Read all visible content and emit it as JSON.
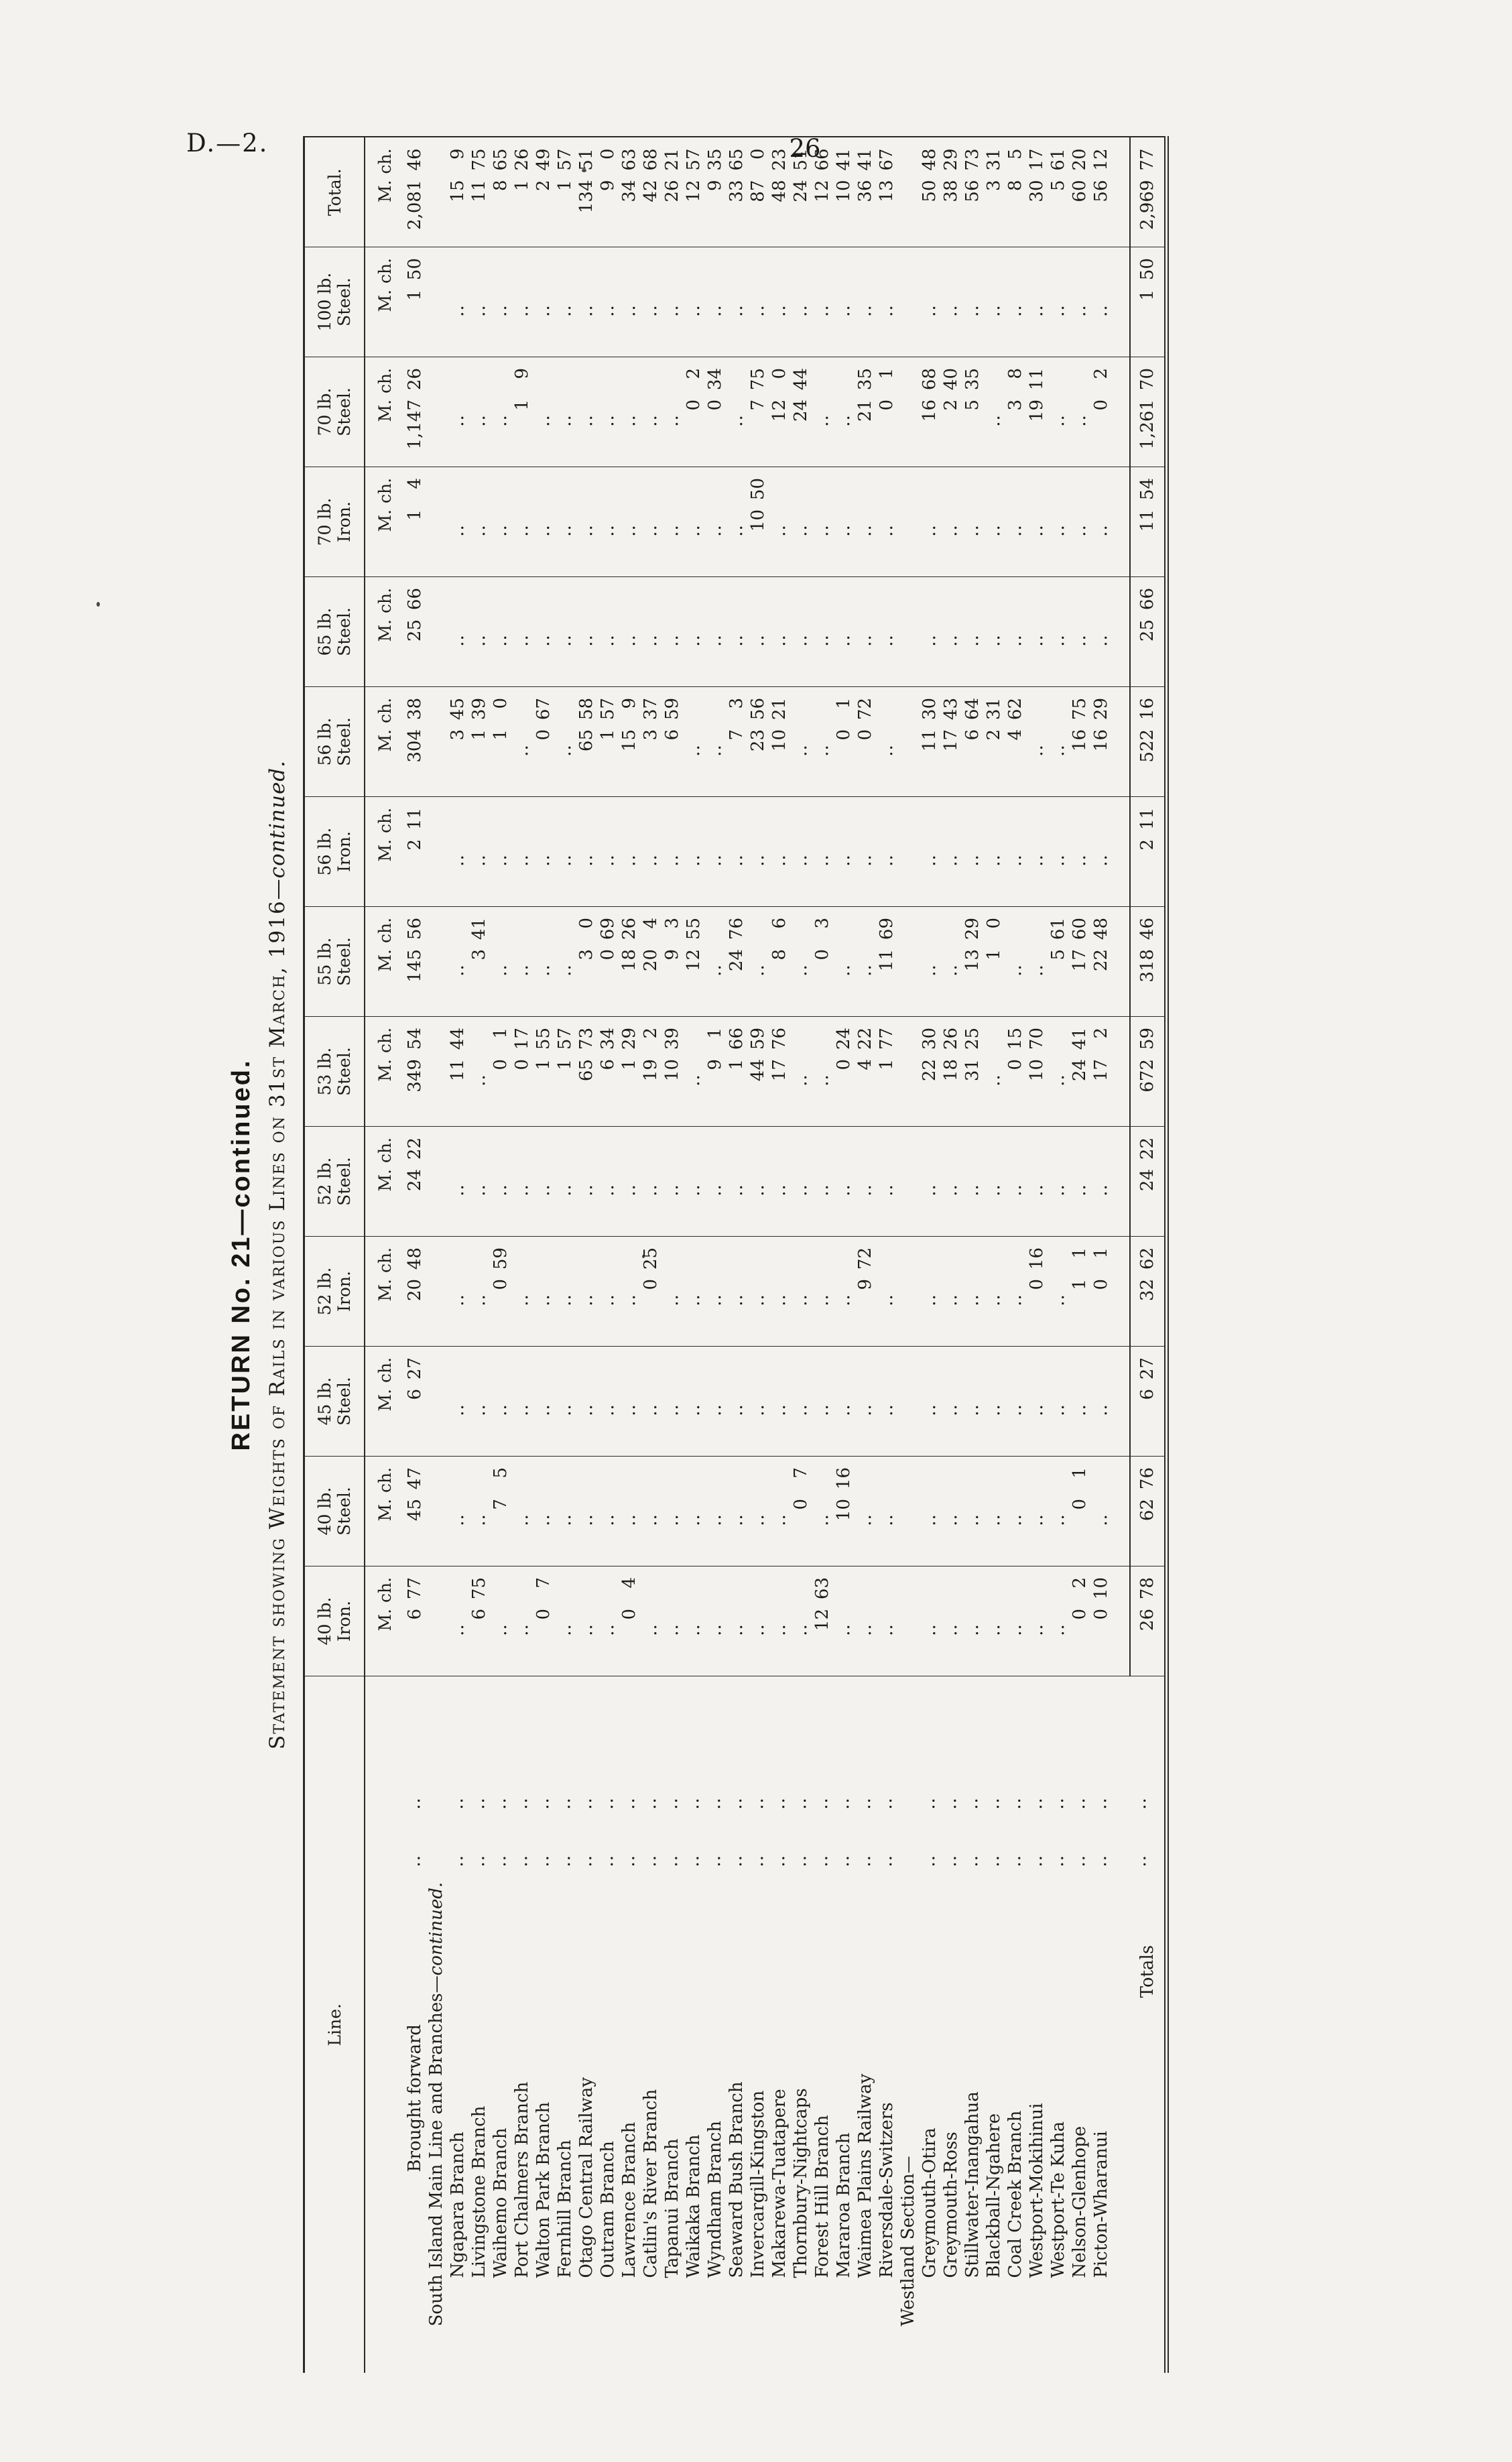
{
  "page": {
    "doc_ref": "D.—2.",
    "page_number": "26"
  },
  "titles": {
    "return_line": "RETURN No. 21—continued.",
    "statement_main": "Statement showing Weights of Rails in various Lines on 31st March, 1916",
    "statement_continued": "—continued."
  },
  "table": {
    "line_column_header": "Line.",
    "subheader": {
      "miles": "M.",
      "chains": "ch."
    },
    "columns": [
      {
        "lines": [
          "40 lb.",
          "Iron."
        ]
      },
      {
        "lines": [
          "40 lb.",
          "Steel."
        ]
      },
      {
        "lines": [
          "45 lb.",
          "Steel."
        ]
      },
      {
        "lines": [
          "52 lb.",
          "Iron."
        ]
      },
      {
        "lines": [
          "52 lb.",
          "Steel."
        ]
      },
      {
        "lines": [
          "53 lb.",
          "Steel."
        ]
      },
      {
        "lines": [
          "55 lb.",
          "Steel."
        ]
      },
      {
        "lines": [
          "56 lb.",
          "Iron."
        ]
      },
      {
        "lines": [
          "56 lb.",
          "Steel."
        ]
      },
      {
        "lines": [
          "65 lb.",
          "Steel."
        ]
      },
      {
        "lines": [
          "70 lb.",
          "Iron."
        ]
      },
      {
        "lines": [
          "70 lb.",
          "Steel."
        ]
      },
      {
        "lines": [
          "100 lb.",
          "Steel."
        ]
      },
      {
        "lines": [
          "Total."
        ]
      }
    ],
    "rows": [
      {
        "name": "Brought forward",
        "suffix": "",
        "type": "data",
        "indent": "brought",
        "leaders": ".. ..",
        "values": [
          "6 77",
          "45 47",
          "6 27",
          "20 48",
          "24 22",
          "349 54",
          "145 56",
          "2 11",
          "304 38",
          "25 66",
          "1 4",
          "1,147 26",
          "1 50",
          "2,081 46"
        ]
      },
      {
        "name": "South Island Main Line and Branches",
        "suffix": "—continued.",
        "type": "section",
        "indent": "section",
        "leaders": "",
        "values": [
          "",
          "",
          "",
          "",
          "",
          "",
          "",
          "",
          "",
          "",
          "",
          "",
          "",
          ""
        ]
      },
      {
        "name": "Ngapara Branch",
        "suffix": "",
        "type": "data",
        "indent": "branch",
        "leaders": ".. ..",
        "values": [
          "..",
          "..",
          "..",
          "..",
          "..",
          "11 44",
          "..",
          "..",
          "3 45",
          "..",
          "..",
          "..",
          "..",
          "15 9"
        ]
      },
      {
        "name": "Livingstone Branch",
        "suffix": "",
        "type": "data",
        "indent": "branch",
        "leaders": ".. ..",
        "values": [
          "6 75",
          "..",
          "..",
          "..",
          "..",
          "..",
          "3 41",
          "..",
          "1 39",
          "..",
          "..",
          "..",
          "..",
          "11 75"
        ]
      },
      {
        "name": "Waihemo Branch",
        "suffix": "",
        "type": "data",
        "indent": "branch",
        "leaders": ".. ..",
        "values": [
          "..",
          "7 5",
          "..",
          "0 59",
          "..",
          "0 1",
          "..",
          "..",
          "1 0",
          "..",
          "..",
          "..",
          "..",
          "8 65"
        ]
      },
      {
        "name": "Port Chalmers Branch",
        "suffix": "",
        "type": "data",
        "indent": "branch",
        "leaders": ".. ..",
        "values": [
          "..",
          "..",
          "..",
          "..",
          "..",
          "0 17",
          "..",
          "..",
          "..",
          "..",
          "..",
          "1 9",
          "..",
          "1 26"
        ]
      },
      {
        "name": "Walton Park Branch",
        "suffix": "",
        "type": "data",
        "indent": "branch",
        "leaders": ".. ..",
        "values": [
          "0 7",
          "..",
          "..",
          "..",
          "..",
          "1 55",
          "..",
          "..",
          "0 67",
          "..",
          "..",
          "..",
          "..",
          "2 49"
        ]
      },
      {
        "name": "Fernhill Branch",
        "suffix": "",
        "type": "data",
        "indent": "branch",
        "leaders": ".. ..",
        "values": [
          "..",
          "..",
          "..",
          "..",
          "..",
          "1 57",
          "..",
          "..",
          "..",
          "..",
          "..",
          "..",
          "..",
          "1 57"
        ]
      },
      {
        "name": "Otago Central Railway",
        "suffix": "",
        "type": "data",
        "indent": "branch",
        "leaders": ".. ..",
        "values": [
          "..",
          "..",
          "..",
          "..",
          "..",
          "65 73",
          "3 0",
          "..",
          "65 58",
          "..",
          "..",
          "..",
          "..",
          "134 51"
        ]
      },
      {
        "name": "Outram Branch",
        "suffix": "",
        "type": "data",
        "indent": "branch",
        "leaders": ".. ..",
        "values": [
          "..",
          "..",
          "..",
          "..",
          "..",
          "6 34",
          "0 69",
          "..",
          "1 57",
          "..",
          "..",
          "..",
          "..",
          "9 0"
        ]
      },
      {
        "name": "Lawrence Branch",
        "suffix": "",
        "type": "data",
        "indent": "branch",
        "leaders": ".. ..",
        "values": [
          "0 4",
          "..",
          "..",
          "..",
          "..",
          "1 29",
          "18 26",
          "..",
          "15 9",
          "..",
          "..",
          "..",
          "..",
          "34 63"
        ]
      },
      {
        "name": "Catlin's River Branch",
        "suffix": "",
        "type": "data",
        "indent": "branch",
        "leaders": ".. ..",
        "values": [
          "..",
          "..",
          "..",
          "0 25",
          "..",
          "19 2",
          "20 4",
          "..",
          "3 37",
          "..",
          "..",
          "..",
          "..",
          "42 68"
        ]
      },
      {
        "name": "Tapanui Branch",
        "suffix": "",
        "type": "data",
        "indent": "branch",
        "leaders": ".. ..",
        "values": [
          "..",
          "..",
          "..",
          "..",
          "..",
          "10 39",
          "9 3",
          "..",
          "6 59",
          "..",
          "..",
          "..",
          "..",
          "26 21"
        ]
      },
      {
        "name": "Waikaka Branch",
        "suffix": "",
        "type": "data",
        "indent": "branch",
        "leaders": ".. ..",
        "values": [
          "..",
          "..",
          "..",
          "..",
          "..",
          "..",
          "12 55",
          "..",
          "..",
          "..",
          "..",
          "0 2",
          "..",
          "12 57"
        ]
      },
      {
        "name": "Wyndham Branch",
        "suffix": "",
        "type": "data",
        "indent": "branch",
        "leaders": ".. ..",
        "values": [
          "..",
          "..",
          "..",
          "..",
          "..",
          "9 1",
          "..",
          "..",
          "..",
          "..",
          "..",
          "0 34",
          "..",
          "9 35"
        ]
      },
      {
        "name": "Seaward Bush Branch",
        "suffix": "",
        "type": "data",
        "indent": "branch",
        "leaders": ".. ..",
        "values": [
          "..",
          "..",
          "..",
          "..",
          "..",
          "1 66",
          "24 76",
          "..",
          "7 3",
          "..",
          "..",
          "..",
          "..",
          "33 65"
        ]
      },
      {
        "name": "Invercargill-Kingston",
        "suffix": "",
        "type": "data",
        "indent": "branch",
        "leaders": ".. ..",
        "values": [
          "..",
          "..",
          "..",
          "..",
          "..",
          "44 59",
          "..",
          "..",
          "23 56",
          "..",
          "10 50",
          "7 75",
          "..",
          "87 0"
        ]
      },
      {
        "name": "Makarewa-Tuatapere",
        "suffix": "",
        "type": "data",
        "indent": "branch",
        "leaders": ".. ..",
        "values": [
          "..",
          "..",
          "..",
          "..",
          "..",
          "17 76",
          "8 6",
          "..",
          "10 21",
          "..",
          "..",
          "12 0",
          "..",
          "48 23"
        ]
      },
      {
        "name": "Thornbury-Nightcaps",
        "suffix": "",
        "type": "data",
        "indent": "branch",
        "leaders": ".. ..",
        "values": [
          "..",
          "0 7",
          "..",
          "..",
          "..",
          "..",
          "..",
          "..",
          "..",
          "..",
          "..",
          "24 44",
          "..",
          "24 51"
        ]
      },
      {
        "name": "Forest Hill Branch",
        "suffix": "",
        "type": "data",
        "indent": "branch",
        "leaders": ".. ..",
        "values": [
          "12 63",
          "..",
          "..",
          "..",
          "..",
          "..",
          "0 3",
          "..",
          "..",
          "..",
          "..",
          "..",
          "..",
          "12 66"
        ]
      },
      {
        "name": "Mararoa Branch",
        "suffix": "",
        "type": "data",
        "indent": "branch",
        "leaders": ".. ..",
        "values": [
          "..",
          "10 16",
          "..",
          "..",
          "..",
          "0 24",
          "..",
          "..",
          "0 1",
          "..",
          "..",
          "..",
          "..",
          "10 41"
        ]
      },
      {
        "name": "Waimea Plains Railway",
        "suffix": "",
        "type": "data",
        "indent": "branch",
        "leaders": ".. ..",
        "values": [
          "..",
          "..",
          "..",
          "9 72",
          "..",
          "4 22",
          "..",
          "..",
          "0 72",
          "..",
          "..",
          "21 35",
          "..",
          "36 41"
        ]
      },
      {
        "name": "Riversdale-Switzers",
        "suffix": "",
        "type": "data",
        "indent": "branch",
        "leaders": ".. ..",
        "values": [
          "..",
          "..",
          "..",
          "..",
          "..",
          "1 77",
          "11 69",
          "..",
          "..",
          "..",
          "..",
          "0 1",
          "..",
          "13 67"
        ]
      },
      {
        "name": "Westland Section—",
        "suffix": "",
        "type": "section",
        "indent": "section",
        "leaders": "",
        "values": [
          "",
          "",
          "",
          "",
          "",
          "",
          "",
          "",
          "",
          "",
          "",
          "",
          "",
          ""
        ]
      },
      {
        "name": "Greymouth-Otira",
        "suffix": "",
        "type": "data",
        "indent": "branch",
        "leaders": ".. ..",
        "values": [
          "..",
          "..",
          "..",
          "..",
          "..",
          "22 30",
          "..",
          "..",
          "11 30",
          "..",
          "..",
          "16 68",
          "..",
          "50 48"
        ]
      },
      {
        "name": "Greymouth-Ross",
        "suffix": "",
        "type": "data",
        "indent": "branch",
        "leaders": ".. ..",
        "values": [
          "..",
          "..",
          "..",
          "..",
          "..",
          "18 26",
          "..",
          "..",
          "17 43",
          "..",
          "..",
          "2 40",
          "..",
          "38 29"
        ]
      },
      {
        "name": "Stillwater-Inangahua",
        "suffix": "",
        "type": "data",
        "indent": "branch",
        "leaders": ".. ..",
        "values": [
          "..",
          "..",
          "..",
          "..",
          "..",
          "31 25",
          "13 29",
          "..",
          "6 64",
          "..",
          "..",
          "5 35",
          "..",
          "56 73"
        ]
      },
      {
        "name": "Blackball-Ngahere",
        "suffix": "",
        "type": "data",
        "indent": "branch",
        "leaders": ".. ..",
        "values": [
          "..",
          "..",
          "..",
          "..",
          "..",
          "..",
          "1 0",
          "..",
          "2 31",
          "..",
          "..",
          "..",
          "..",
          "3 31"
        ]
      },
      {
        "name": "Coal Creek Branch",
        "suffix": "",
        "type": "data",
        "indent": "branch",
        "leaders": ".. ..",
        "values": [
          "..",
          "..",
          "..",
          "..",
          "..",
          "0 15",
          "..",
          "..",
          "4 62",
          "..",
          "..",
          "3 8",
          "..",
          "8 5"
        ]
      },
      {
        "name": "Westport-Mokihinui",
        "suffix": "",
        "type": "data",
        "indent": "branch",
        "leaders": ".. ..",
        "values": [
          "..",
          "..",
          "..",
          "0 16",
          "..",
          "10 70",
          "..",
          "..",
          "..",
          "..",
          "..",
          "19 11",
          "..",
          "30 17"
        ]
      },
      {
        "name": "Westport-Te Kuha",
        "suffix": "",
        "type": "data",
        "indent": "branch",
        "leaders": ".. ..",
        "values": [
          "..",
          "..",
          "..",
          "..",
          "..",
          "..",
          "5 61",
          "..",
          "..",
          "..",
          "..",
          "..",
          "..",
          "5 61"
        ]
      },
      {
        "name": "Nelson-Glenhope",
        "suffix": "",
        "type": "data",
        "indent": "branch",
        "leaders": ".. ..",
        "values": [
          "0 2",
          "0 1",
          "..",
          "1 1",
          "..",
          "24 41",
          "17 60",
          "..",
          "16 75",
          "..",
          "..",
          "..",
          "..",
          "60 20"
        ]
      },
      {
        "name": "Picton-Wharanui",
        "suffix": "",
        "type": "data",
        "indent": "branch",
        "leaders": ".. ..",
        "values": [
          "0 10",
          "..",
          "..",
          "0 1",
          "..",
          "17 2",
          "22 48",
          "..",
          "16 29",
          "..",
          "..",
          "0 2",
          "..",
          "56 12"
        ]
      },
      {
        "name": "Totals",
        "suffix": "",
        "type": "totals",
        "indent": "totals",
        "leaders": ".. ..",
        "values": [
          "26 78",
          "62 76",
          "6 27",
          "32 62",
          "24 22",
          "672 59",
          "318 46",
          "2 11",
          "522 16",
          "25 66",
          "11 54",
          "1,261 70",
          "1 50",
          "2,969 77"
        ]
      }
    ]
  }
}
